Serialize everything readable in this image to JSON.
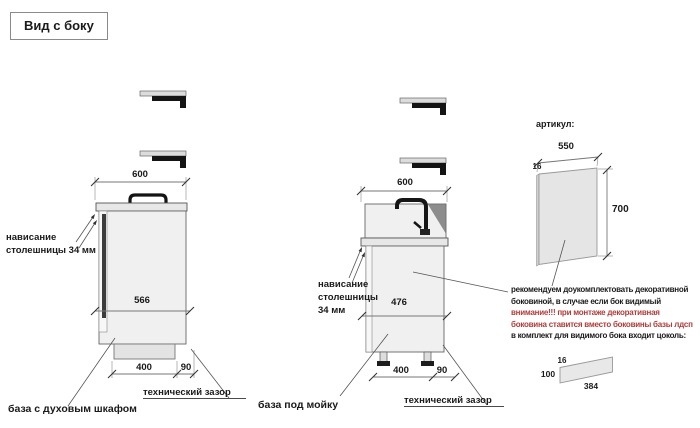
{
  "title": "Вид с боку",
  "oven_base": {
    "label": "база с духовым шкафом",
    "top_width": "600",
    "inner_width": "566",
    "depth": "400",
    "gap": "90",
    "overhang_l1": "нависание",
    "overhang_l2": "столешницы 34 мм",
    "gap_label": "технический зазор"
  },
  "sink_base": {
    "label": "база под мойку",
    "top_width": "600",
    "inner_width": "476",
    "depth": "400",
    "gap": "90",
    "overhang_l1": "нависание",
    "overhang_l2": "столешницы",
    "overhang_l3": "34 мм",
    "gap_label": "технический зазор"
  },
  "side_panel": {
    "article_label": "артикул:",
    "width": "550",
    "thickness": "16",
    "height": "700",
    "note_l1": "рекомендуем доукомплектовать декоративной",
    "note_l2": "боковиной, в случае если бок видимый",
    "note_l3": "внимание!!! при монтаже декоративная",
    "note_l4": "боковина ставится вместо боковины базы лдсп",
    "note_l5": "в комплект для видимого бока входит цоколь:"
  },
  "plinth": {
    "thickness": "16",
    "height": "100",
    "length": "384"
  },
  "icons": {
    "wall_bracket": "L-shaped wall bracket section",
    "oven_handle": "oven door handle",
    "faucet": "kitchen mixer tap",
    "sink_shadow": "sink bowl shading",
    "leg": "adjustable cabinet leg"
  },
  "colors": {
    "red_text": "#b03b3b",
    "line": "#777777",
    "tick": "#333333",
    "fill_light": "#f0f0f0",
    "fill_mid": "#e7e7e7",
    "dark": "#141414",
    "sink_shadow": "#8d8d8d"
  }
}
